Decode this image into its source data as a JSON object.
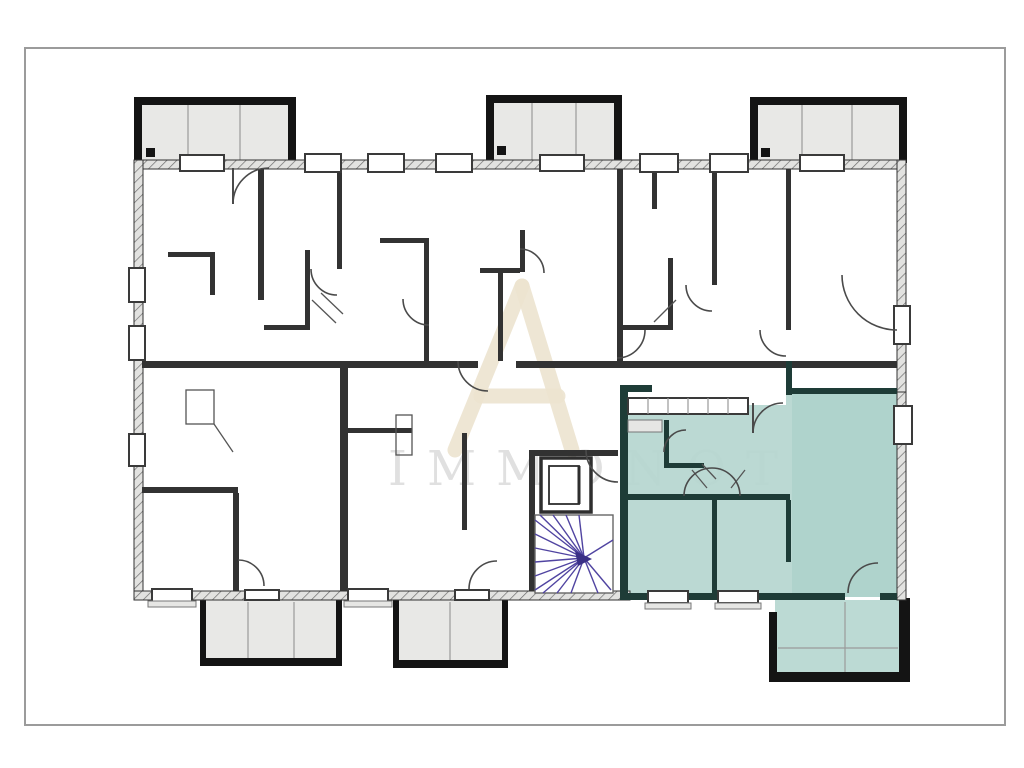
{
  "document": {
    "type": "architectural-floor-plan",
    "description": "Building storey plan with three top balconies, three bottom balconies, central elevator and winder staircase, and one apartment unit highlighted in teal at the lower right"
  },
  "watermark": {
    "text": "IMMONOT"
  },
  "colors": {
    "page_bg": "#ffffff",
    "frame": "#9b9b9b",
    "wall": "#323232",
    "wall_dark": "#141414",
    "exterior_hatch_bg": "#e2e2e0",
    "exterior_hatch_line": "#6e6e6e",
    "balcony_fill": "#e8e8e6",
    "highlight_fill": "#b5d6cf",
    "highlight_fill_strong": "#a6cec6",
    "highlight_wall": "#1e3c37",
    "stair": "#5044a1",
    "door": "#4a4a4a",
    "window_fill": "#ffffff",
    "window_frame": "#3a3a3a",
    "watermark_logo": "#ece3cf",
    "watermark_text": "#c7c7c7"
  }
}
